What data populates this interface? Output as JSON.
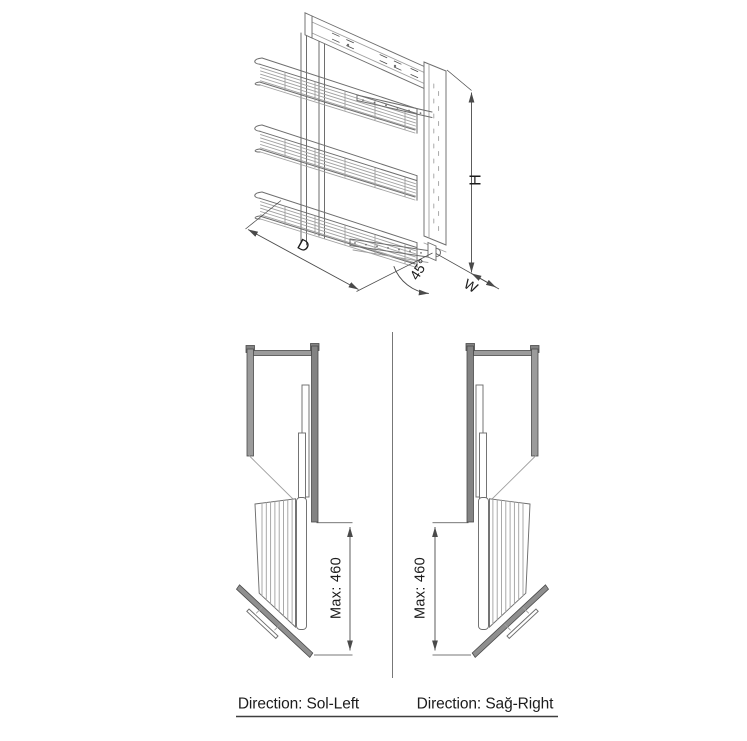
{
  "iso_view": {
    "dim_depth_label": "D",
    "dim_height_label": "H",
    "dim_width_label": "W",
    "dim_angle_label": "45°"
  },
  "plan_views": {
    "left": {
      "max_extension_label": "Max: 460",
      "caption": "Direction: Sol-Left"
    },
    "right": {
      "max_extension_label": "Max: 460",
      "caption": "Direction: Sağ-Right"
    }
  },
  "colors": {
    "line": "#6e6e6e",
    "line_light": "#a0a0a0",
    "line_dark": "#4a4a4a",
    "wall_fill": "#9b9b9b",
    "wall_dark_fill": "#838383",
    "door_fill": "#8f8f8f",
    "text": "#1c1c1c",
    "background": "#ffffff"
  }
}
